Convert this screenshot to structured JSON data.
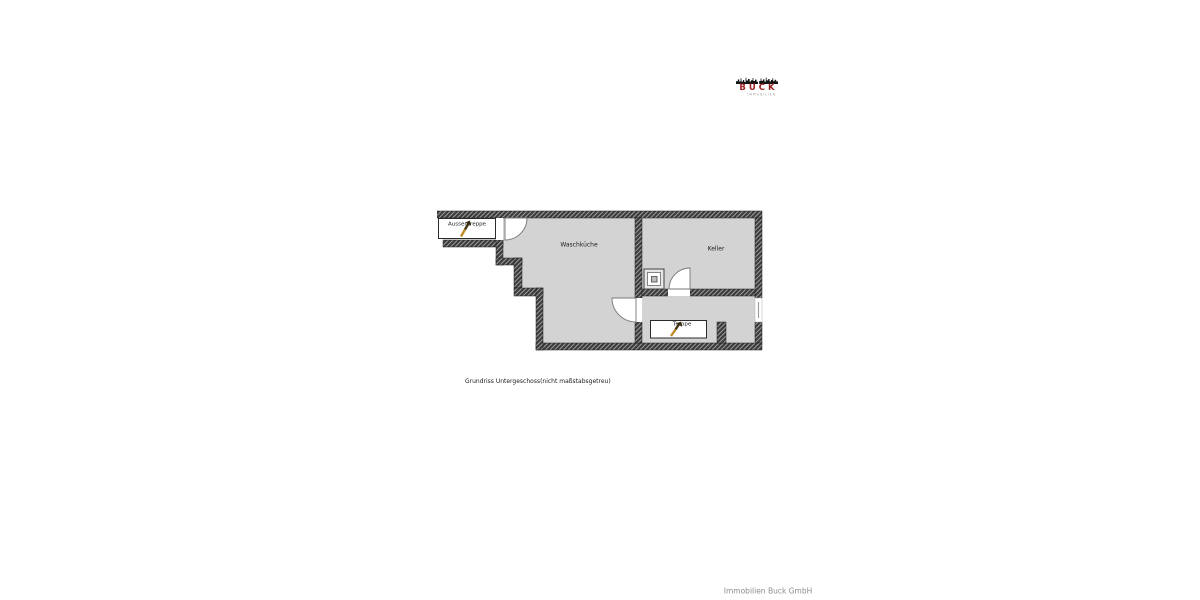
{
  "logo": {
    "brand": "BUCK",
    "subtitle": "IMMOBILIEN"
  },
  "floorplan": {
    "labels": {
      "waschkueche": "Waschküche",
      "keller": "Keller",
      "aussentreppe": "Aussentreppe",
      "treppe": "Treppe"
    },
    "colors": {
      "floor": "#d3d3d3",
      "wall": "#3c3c3c",
      "hatch": "#9a9a9a",
      "stair-arrow-dark": "#453410",
      "stair-arrow-light": "#c08a28",
      "brand-red": "#9b2222",
      "subtitle-gray": "#a8a8a8",
      "footer-gray": "#8c8c8c"
    }
  },
  "caption": "Grundriss Untergeschoss(nicht maßstabsgetreu)",
  "footer": "Immobilien Buck GmbH"
}
